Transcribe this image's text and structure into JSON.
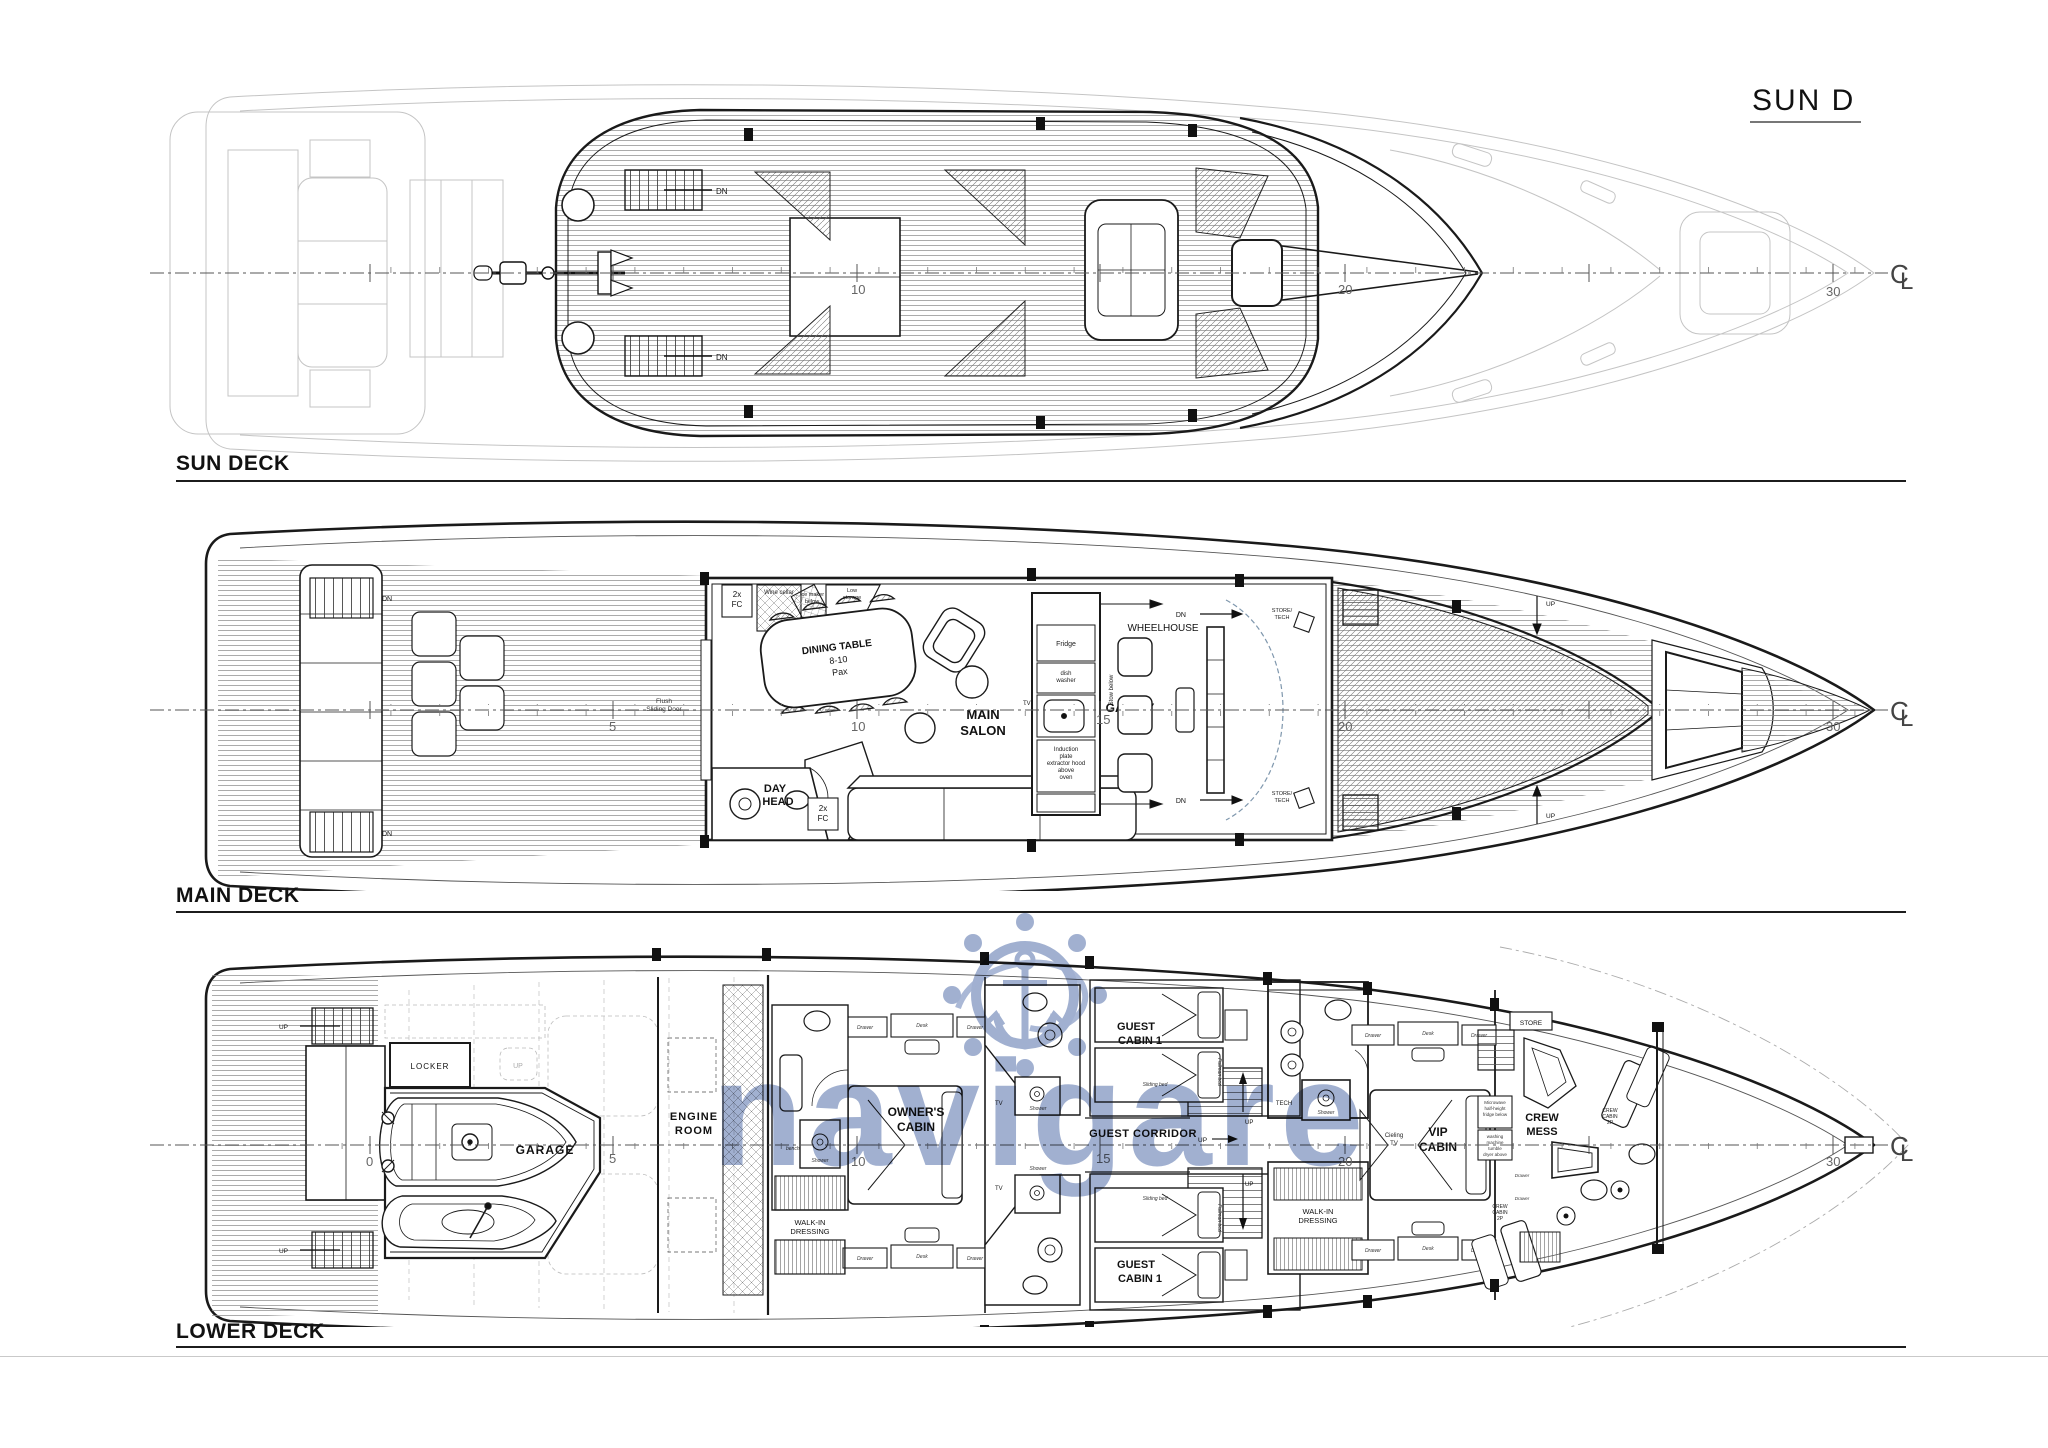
{
  "header": {
    "plan_code": "SUN D"
  },
  "watermark": {
    "brand": "navigare"
  },
  "scale": {
    "n0": "0",
    "n5": "5",
    "n10": "10",
    "n15": "15",
    "n20": "20",
    "n30": "30",
    "cl_c": "C",
    "cl_l": "L"
  },
  "sun": {
    "title": "SUN DECK",
    "dn": "DN"
  },
  "main": {
    "title": "MAIN DECK",
    "dn": "DN",
    "up": "UP",
    "fc1": "2x",
    "fc2": "FC",
    "wine": "Wine cellar",
    "ice1": "Ice maker",
    "ice2": "below",
    "low1": "Low",
    "low2": "storage",
    "dining1": "DINING TABLE",
    "dining2": "8-10",
    "dining3": "Pax",
    "salon1": "MAIN",
    "salon2": "SALON",
    "tv": "TV",
    "galley": "GALLEY",
    "fridge": "Fridge",
    "dish1": "dish",
    "dish2": "washer",
    "ind1": "Induction",
    "ind2": "plate",
    "ind3": "extractor hood",
    "ind4": "above",
    "ind5": "oven",
    "stow1": "Stow below",
    "wheelhouse": "WHEELHOUSE",
    "store1": "STORE/",
    "store2": "TECH",
    "day1": "DAY",
    "day2": "HEAD",
    "flush1": "Flush",
    "flush2": "Sliding Door"
  },
  "lower": {
    "title": "LOWER DECK",
    "up": "UP",
    "locker": "LOCKER",
    "garage": "GARAGE",
    "engine1": "ENGINE",
    "engine2": "ROOM",
    "owner1": "OWNER'S",
    "owner2": "CABIN",
    "walk1": "WALK-IN",
    "walk2": "DRESSING",
    "bench": "bench",
    "shower": "Shower",
    "drawer": "Drawer",
    "desk": "Desk",
    "guest1": "GUEST",
    "guest2": "CABIN 1",
    "corridor": "GUEST CORRIDOR",
    "sliding": "Sliding bed",
    "pullman": "Pullman bed",
    "tech": "TECH",
    "vip1": "VIP",
    "vip2": "CABIN",
    "ceil1": "Cieling",
    "ceil2": "TV",
    "crewmess1": "CREW",
    "crewmess2": "MESS",
    "crewcab1": "CREW",
    "crewcab2": "CABIN",
    "crewcab3": "2P",
    "store": "STORE",
    "micro1": "Microwave",
    "micro2": "half-height",
    "micro3": "fridge below",
    "wash1": "washing",
    "wash2": "machine",
    "wash3": "tumble",
    "wash4": "dryer above",
    "tv": "TV"
  }
}
